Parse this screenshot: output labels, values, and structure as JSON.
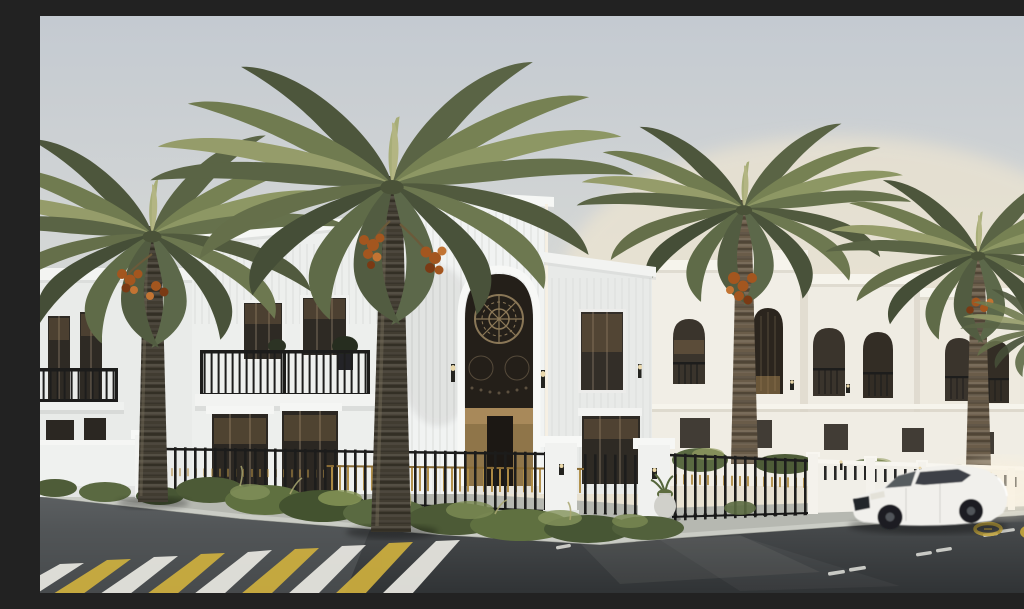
{
  "scene": {
    "type": "architectural-exterior-rendering",
    "description": "Golden-hour 3D rendering of a white luxury villa compound: two-storey fluted villas with tall arched entrances and dark mashrabiya screens, black iron fencing with gold accents, large date palms, landscaped shrubs, a street with a yellow-and-white zebra crosswalk, lane dashes, yellow painted road rings, and a white sedan driving past.",
    "time_of_day": "sunset golden hour"
  },
  "sky": {
    "top": "#c4cad1",
    "mid": "#d7d9d6",
    "warm": "#e6e0d2",
    "horizon": "#efe6d1",
    "glow": "#f6ead0"
  },
  "architecture": {
    "main_villa": {
      "storeys": 2,
      "features": [
        "fluted white facade",
        "tall arched entrance",
        "black ornamental screen",
        "gold entry wall",
        "black balcony railings",
        "wall sconces"
      ]
    },
    "distant_villas": {
      "count": 4,
      "features": [
        "arched windows with dark lattice screens",
        "juliet balconies",
        "white parapets",
        "inner garden wall"
      ]
    },
    "colors": {
      "wall_white": "#f1f3f2",
      "wall_light": "#edefed",
      "wall_wing": "#e9ebe9",
      "wall_shade": "#e8eae8",
      "wall_warm": "#eee9de",
      "unit_warm": "#f1eee6",
      "cornice": "#f6f7f5",
      "garden_wall": "#f0ede4",
      "screen_dark": "#241f19",
      "entry_gold": "#8f7549",
      "glass": "#2e2a24",
      "mullion": "#6e6253",
      "reflection": "#9a7b52"
    }
  },
  "fence": {
    "iron_black": "#1d1d1c",
    "gold": "#b08d45",
    "pier_white": "#f1f2f0",
    "wall_white": "#f1efe8"
  },
  "landscape": {
    "palms": {
      "count": 5,
      "type": "date palm",
      "frond_dark": "#4d563c",
      "frond_mid": "#68734b",
      "frond_light": "#8d9764",
      "frond_pale": "#aaad7a",
      "trunk_dark": "#413c31",
      "trunk_warm": "#6a5c49",
      "dates": "#a3561f"
    },
    "shrubs": {
      "dark": "#43522f",
      "mid": "#5f7040",
      "light": "#82915a",
      "dry_grass": "#a9a771"
    }
  },
  "street": {
    "road_far": "#595c5e",
    "road": "#45484a",
    "road_near": "#303335",
    "sidewalk": "#b6b8b1",
    "curb": "#caccc5",
    "curb_edge": "#73766f",
    "side_street": "#5e6164",
    "crosswalk": {
      "stripe_white": "#e8e7e1",
      "stripe_yellow": "#d2b23e",
      "stripe_count": 9
    },
    "lane_dash": "#e2e2dc",
    "yellow_marking": "#c8a93c"
  },
  "vehicle": {
    "type": "white sedan",
    "body": "#f1f0ec",
    "glass": "#3c4046",
    "wheels": "#1b1e22",
    "motion": "slight motion blur"
  }
}
